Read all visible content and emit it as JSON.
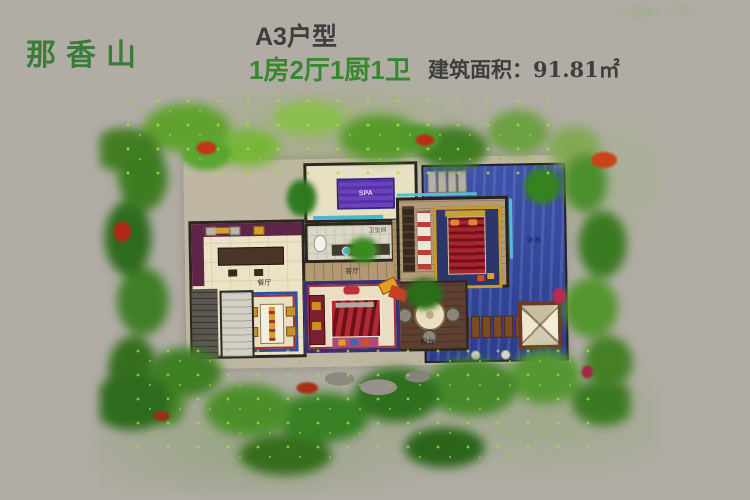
{
  "header": {
    "project_name": "那香山",
    "unit_type": "A3户型",
    "layout_spec": "1房2厅1厨1卫",
    "area": "建筑面积：91.81㎡"
  },
  "floor_plan": {
    "labels": {
      "bathroom": "卫生间",
      "living": "客厅",
      "dining": "餐厅",
      "pool": "泳池",
      "terrace": "阳台",
      "spa": "SPA"
    }
  },
  "colors": {
    "background": "#b1ada5",
    "title_green": "#3a7d3a",
    "accent_green": "#37892f",
    "text_dark": "#3e3e3e",
    "pool_blue": "#34479c",
    "foliage_green": "#4c8f2a",
    "wall_dark": "#2b2620",
    "teal_trim": "#4fc0d4"
  }
}
